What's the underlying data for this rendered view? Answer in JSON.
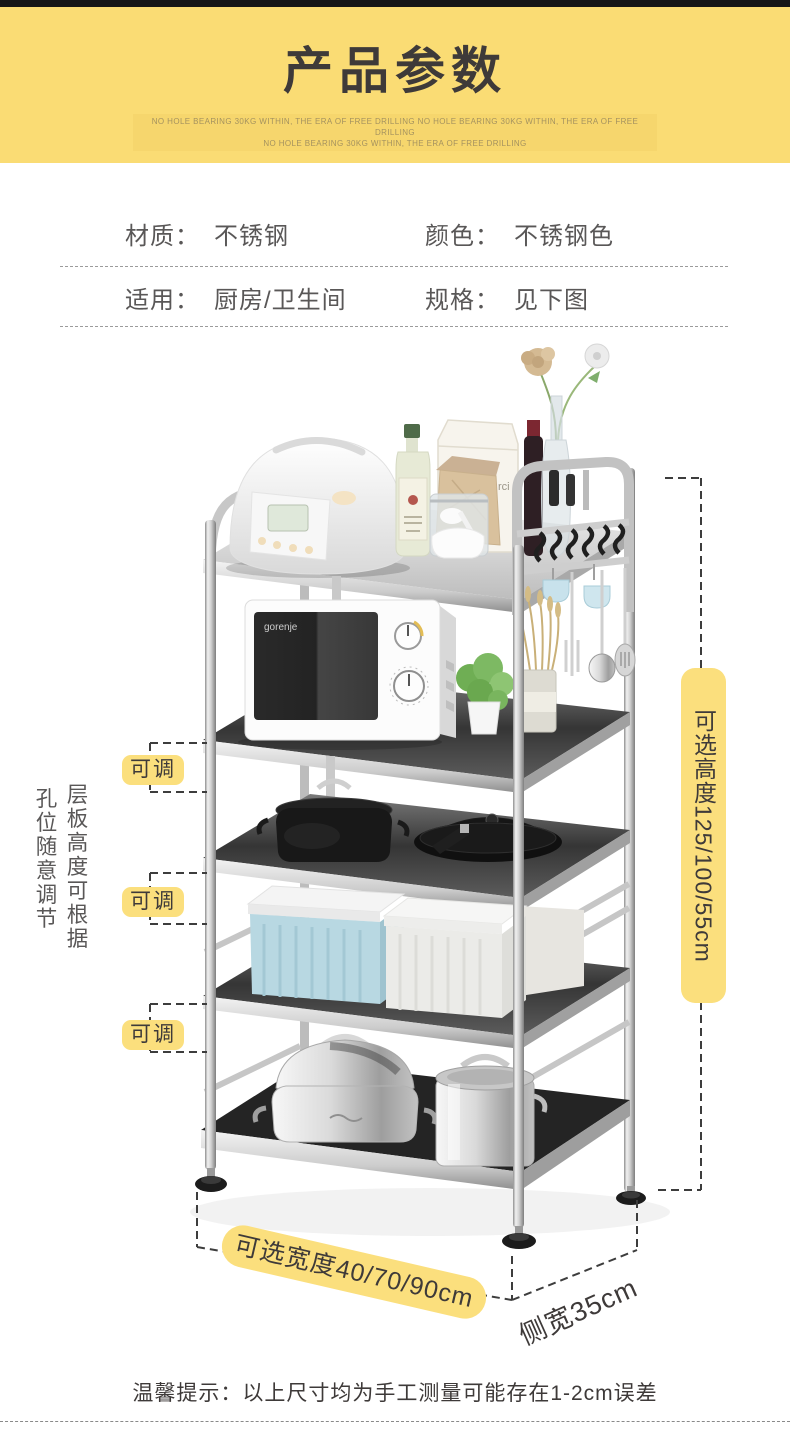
{
  "header": {
    "title": "产品参数",
    "sub_line1": "NO HOLE BEARING 30KG WITHIN, THE ERA OF FREE DRILLING NO HOLE BEARING 30KG WITHIN, THE ERA OF FREE DRILLING",
    "sub_line2": "NO HOLE BEARING 30KG WITHIN, THE ERA OF FREE DRILLING",
    "bg_color": "#FADC74",
    "title_color": "#3E3A39"
  },
  "specs": {
    "rows": [
      {
        "cells": [
          {
            "label": "材质：",
            "value": "不锈钢"
          },
          {
            "label": "颜色：",
            "value": "不锈钢色"
          }
        ]
      },
      {
        "cells": [
          {
            "label": "适用：",
            "value": "厨房/卫生间"
          },
          {
            "label": "规格：",
            "value": "见下图"
          }
        ]
      }
    ]
  },
  "figure": {
    "left_note_col1": "层板高度可根据",
    "left_note_col2": "孔位随意调节",
    "adjust_labels": [
      "可调",
      "可调",
      "可调"
    ],
    "height_note": "可选高度125/100/55cm",
    "width_note": "可选宽度40/70/90cm",
    "side_width_note": "侧宽35cm",
    "highlight_color": "#FBDF7D",
    "product": {
      "microwave_brand": "gorenje",
      "bag_text_line1": "Le sac",
      "bag_text_line2": "rci"
    }
  },
  "footer": {
    "tip": "温馨提示：以上尺寸均为手工测量可能存在1-2cm误差"
  }
}
